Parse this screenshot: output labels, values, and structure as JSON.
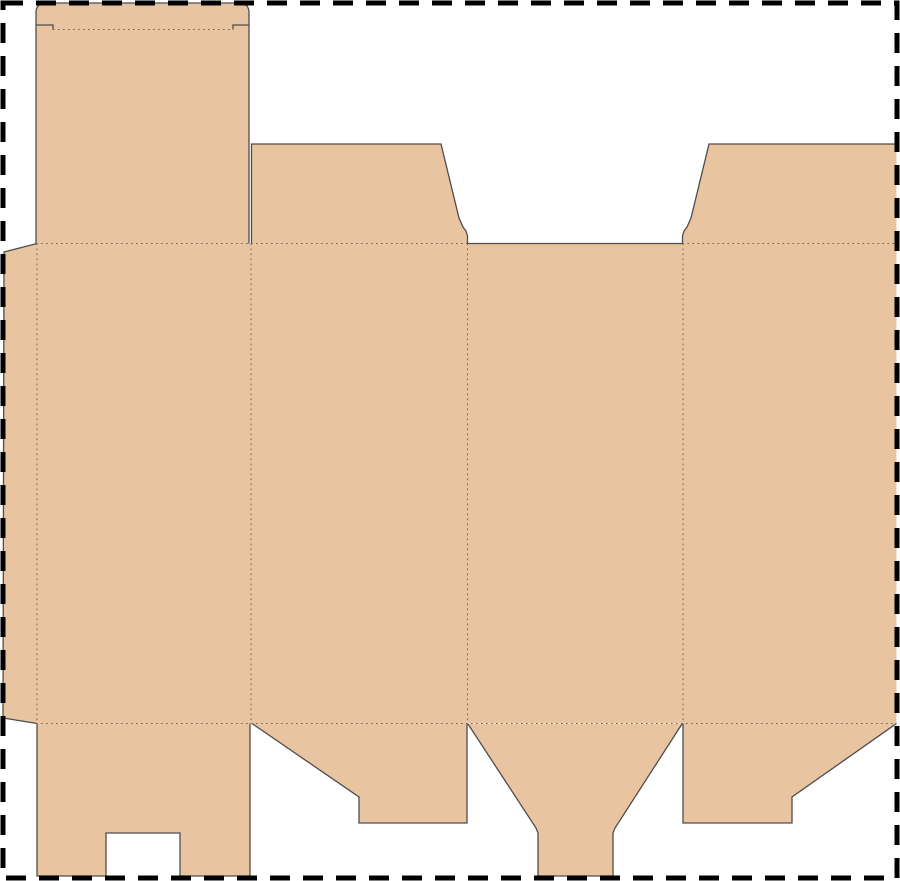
{
  "canvas": {
    "width": 900,
    "height": 881,
    "background_color": "#ffffff"
  },
  "dieline": {
    "description": "flat box packaging dieline template",
    "fill_color": "#e8c4a0",
    "cut_color": "#4d4d4d",
    "cut_width": 1.3,
    "fold_color": "#6e635a",
    "fold_width": 1,
    "fold_dash": "1.6 3.4",
    "border": {
      "color": "#000000",
      "width": 5,
      "dash": "20 13",
      "inset": 3
    },
    "fills": [
      {
        "name": "glue-flap",
        "path": "M4,252 L37,243.5 L37,723.5 L3,718 Z"
      },
      {
        "name": "tuck-lid-panel",
        "path": "M36,243.5 L36,13 Q36,3 46,3 L239,3 Q249,3 249,13 L249,243.5 Z"
      },
      {
        "name": "top-flap-left",
        "path": "M251.5,243.5 L251.5,144 L441,144 L459,218 L463,227 L466,231 L467.5,236 L467.5,243.5 Z"
      },
      {
        "name": "top-flap-right",
        "path": "M682.5,243.5 L682.5,236 L684,231 L687,227 L691,218 L709,144 L896.5,144 L896.5,243.5 Z"
      },
      {
        "name": "main-body-panels",
        "path": "M36,243.5 L896.5,243.5 L896.5,723.5 L36,723.5 Z"
      },
      {
        "name": "bottom-flap-1",
        "path": "M37,723.5 L250,723.5 L250,876 L180,876 L180,833 L106,833 L106,876 L37,876 Z"
      },
      {
        "name": "bottom-flap-2",
        "path": "M252,723.5 L467,723.5 L467,823 L359,823 L359,797 Z"
      },
      {
        "name": "bottom-flap-3",
        "path": "M468,724 L682,724 L615,828 L613,833 L613,876 L538,876 L538,833 L536,828 Z"
      },
      {
        "name": "bottom-flap-4",
        "path": "M683,723.5 L896.5,723.5 L792,797 L792,823 L683,823 Z"
      }
    ],
    "cuts": [
      {
        "name": "tuck-lid-outline",
        "path": "M36,243.5 L36,13 Q36,3 46,3 L239,3 Q249,3 249,13 L249,243.5"
      },
      {
        "name": "tuck-slit-left",
        "path": "M36,25 L53,25 L53,29.5"
      },
      {
        "name": "tuck-slit-right",
        "path": "M233,29.5 L233,25 L249,25"
      },
      {
        "name": "top-flap-left-outline",
        "path": "M251.5,243.5 L251.5,144 L441,144 L459,218 L463,227 L466,231 L467.5,236 L467.5,243.5"
      },
      {
        "name": "top-flap-right-outline",
        "path": "M682.5,243.5 L682.5,236 L684,231 L687,227 L691,218 L709,144 L896.5,144"
      },
      {
        "name": "panel-3-top-edge",
        "path": "M467.5,243.5 L682.5,243.5"
      },
      {
        "name": "glue-flap-outline",
        "path": "M37,243.5 L4,252 L3,718 L37,723.5"
      },
      {
        "name": "bottom-flap-1-outline",
        "path": "M37,723.5 L37,876 L106,876 L106,833 L180,833 L180,876 L250,876 L250,723.5"
      },
      {
        "name": "bottom-flap-2-outline",
        "path": "M252,723.5 L359,797 L359,823 L467,823 L467,723.5"
      },
      {
        "name": "bottom-flap-3-outline",
        "path": "M468,724 L536,828 L538,833 L538,876 L613,876 L613,833 L615,828 L682,724"
      },
      {
        "name": "bottom-flap-4-outline",
        "path": "M683,723.5 L683,823 L792,823 L792,797 L896.5,723.5"
      }
    ],
    "folds": [
      {
        "name": "tuck-fold",
        "path": "M53,29.5 L233,29.5"
      },
      {
        "name": "top-fold-left-span",
        "path": "M36,243.5 L467.5,243.5"
      },
      {
        "name": "top-fold-right-span",
        "path": "M682.5,243.5 L896.5,243.5"
      },
      {
        "name": "bottom-fold",
        "path": "M36,723.5 L896.5,723.5"
      },
      {
        "name": "glue-fold",
        "path": "M37,243.5 L37,723.5"
      },
      {
        "name": "panel-fold-1",
        "path": "M251,243.5 L251,723.5"
      },
      {
        "name": "panel-fold-2",
        "path": "M467.5,243.5 L467.5,723.5"
      },
      {
        "name": "panel-fold-3",
        "path": "M683,243.5 L683,723.5"
      }
    ]
  }
}
